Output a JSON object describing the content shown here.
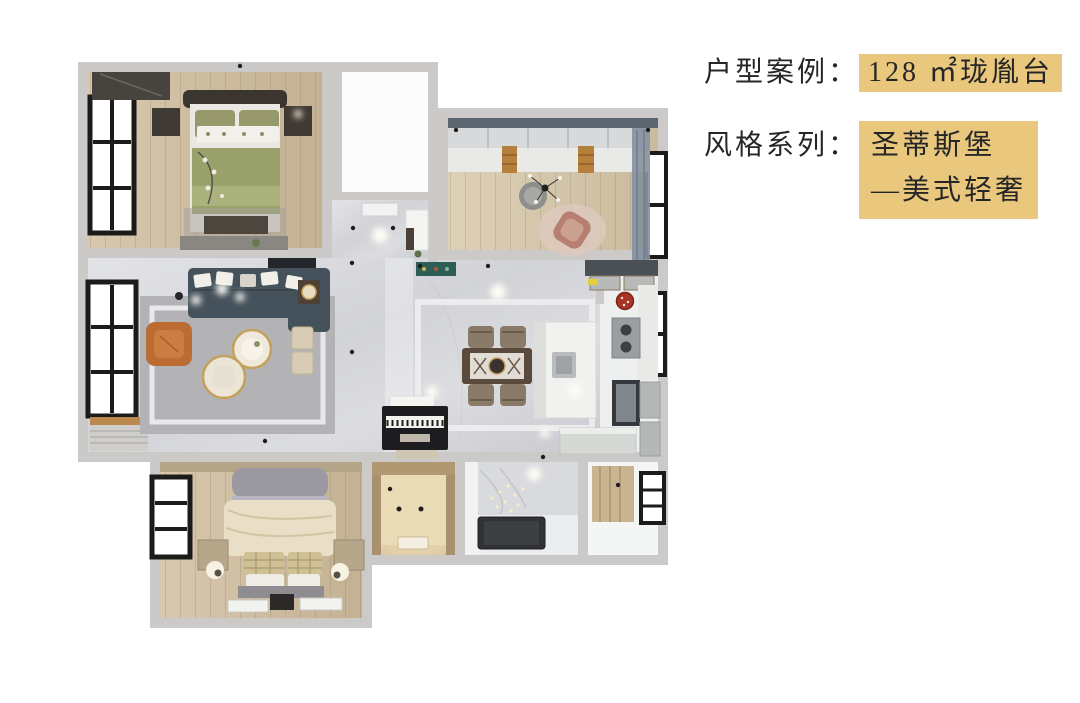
{
  "canvas": {
    "background": "#ffffff"
  },
  "info_panel": {
    "highlight_color": "#e9c87d",
    "text_color": "#262626",
    "case_row": {
      "label": "户型案例：",
      "value": "128 ㎡珑胤台"
    },
    "style_row": {
      "label": "风格系列：",
      "line1": "圣蒂斯堡",
      "line2": "—美式轻奢"
    }
  },
  "floorplan": {
    "type": "3d-rendered-floor-plan-top-view",
    "area_label": "128 ㎡",
    "palette": {
      "wall": "#cbcac8",
      "marble_floor": "#d9dadd",
      "wood_floor": "#cfc0a6",
      "sofa": "#45525c",
      "accent_chair": "#bb6c33",
      "master_bedding": "#99a26b",
      "guest_bedding": "#e9dfc6",
      "study_curtain": "#8793a0",
      "closet_glow": "#ecdcb4",
      "tub": "#303234",
      "window_frame": "#1b1b1b"
    },
    "rooms": [
      "master-bedroom",
      "white-bathroom",
      "study-bedroom",
      "entry-hall",
      "living-room",
      "dining-area",
      "kitchen",
      "guest-bedroom",
      "walkin-closet",
      "bathroom",
      "utility-room"
    ]
  }
}
